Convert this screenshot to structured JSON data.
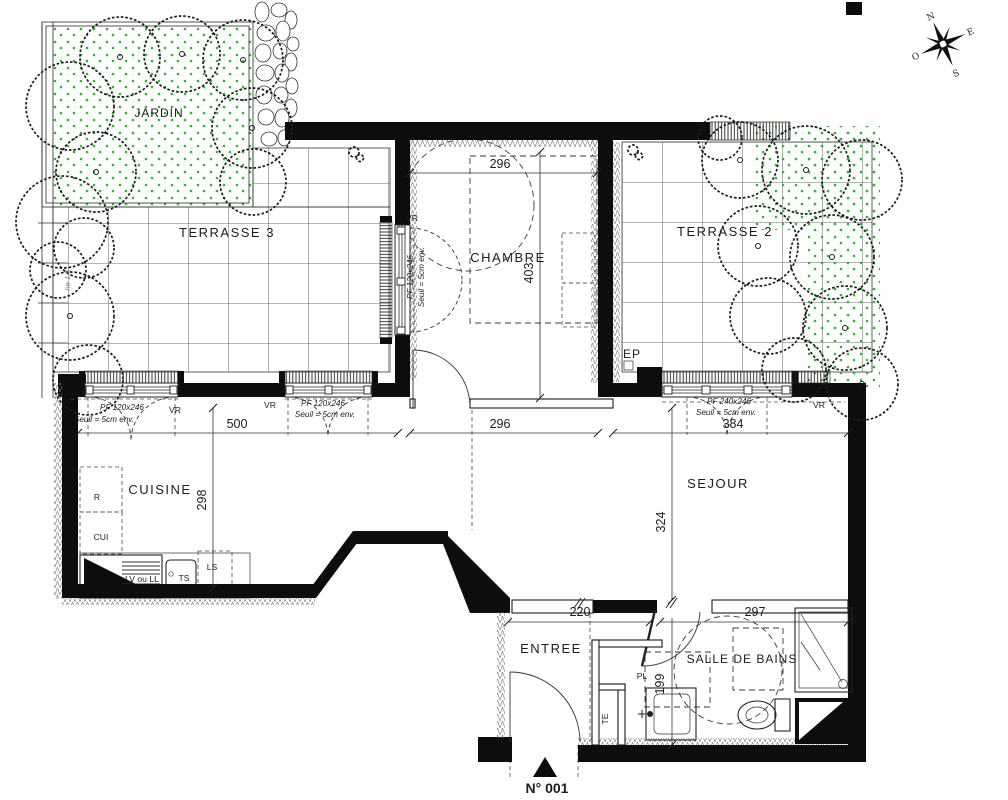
{
  "plan": {
    "title_context": "floor-plan",
    "rooms": {
      "jardin": "JARDIN",
      "terrasse3": "TERRASSE 3",
      "chambre": "CHAMBRE",
      "terrasse2": "TERRASSE 2",
      "cuisine": "CUISINE",
      "sejour": "SEJOUR",
      "entree": "ENTREE",
      "salle_de_bains": "SALLE DE BAINS"
    },
    "dimensions": {
      "chambre_width_top": "296",
      "chambre_depth": "403",
      "cuisine_width": "500",
      "chambre_width": "296",
      "sejour_width": "384",
      "cuisine_depth": "298",
      "sejour_depth": "324",
      "entree_width": "220",
      "salle_de_bains_width": "297",
      "salle_de_bains_depth": "199"
    },
    "windows": {
      "w_chambre": {
        "type": "PF 120x246",
        "seuil": "Seuil = 5cm env.",
        "shutter": "VR"
      },
      "w_cuisine_1": {
        "type": "PF 120x246",
        "seuil": "Seuil = 5cm env.",
        "shutter": "VR"
      },
      "w_cuisine_2": {
        "type": "PF 120x246",
        "seuil": "Seuil = 5cm env.",
        "shutter": "VR"
      },
      "w_sejour": {
        "type": "PF 240x246",
        "seuil": "Seuil = 5cm env.",
        "shutter": "VR"
      }
    },
    "annotations": {
      "ep": "EP",
      "pl": "PL",
      "te": "TE",
      "refrigerator": "R",
      "cooker": "CUI",
      "washer": "LV ou LL",
      "sink_unit": "TS",
      "ls": "LS",
      "fence_note": "he 1,5"
    },
    "compass": {
      "north": "N",
      "east": "E",
      "south": "S",
      "west": "O"
    },
    "lot": {
      "number": "N° 001"
    },
    "colors": {
      "wall": "#0d0d0d",
      "line": "#222222",
      "green_dots": "#2db82d",
      "note_blue": "#7b8fb3"
    }
  }
}
